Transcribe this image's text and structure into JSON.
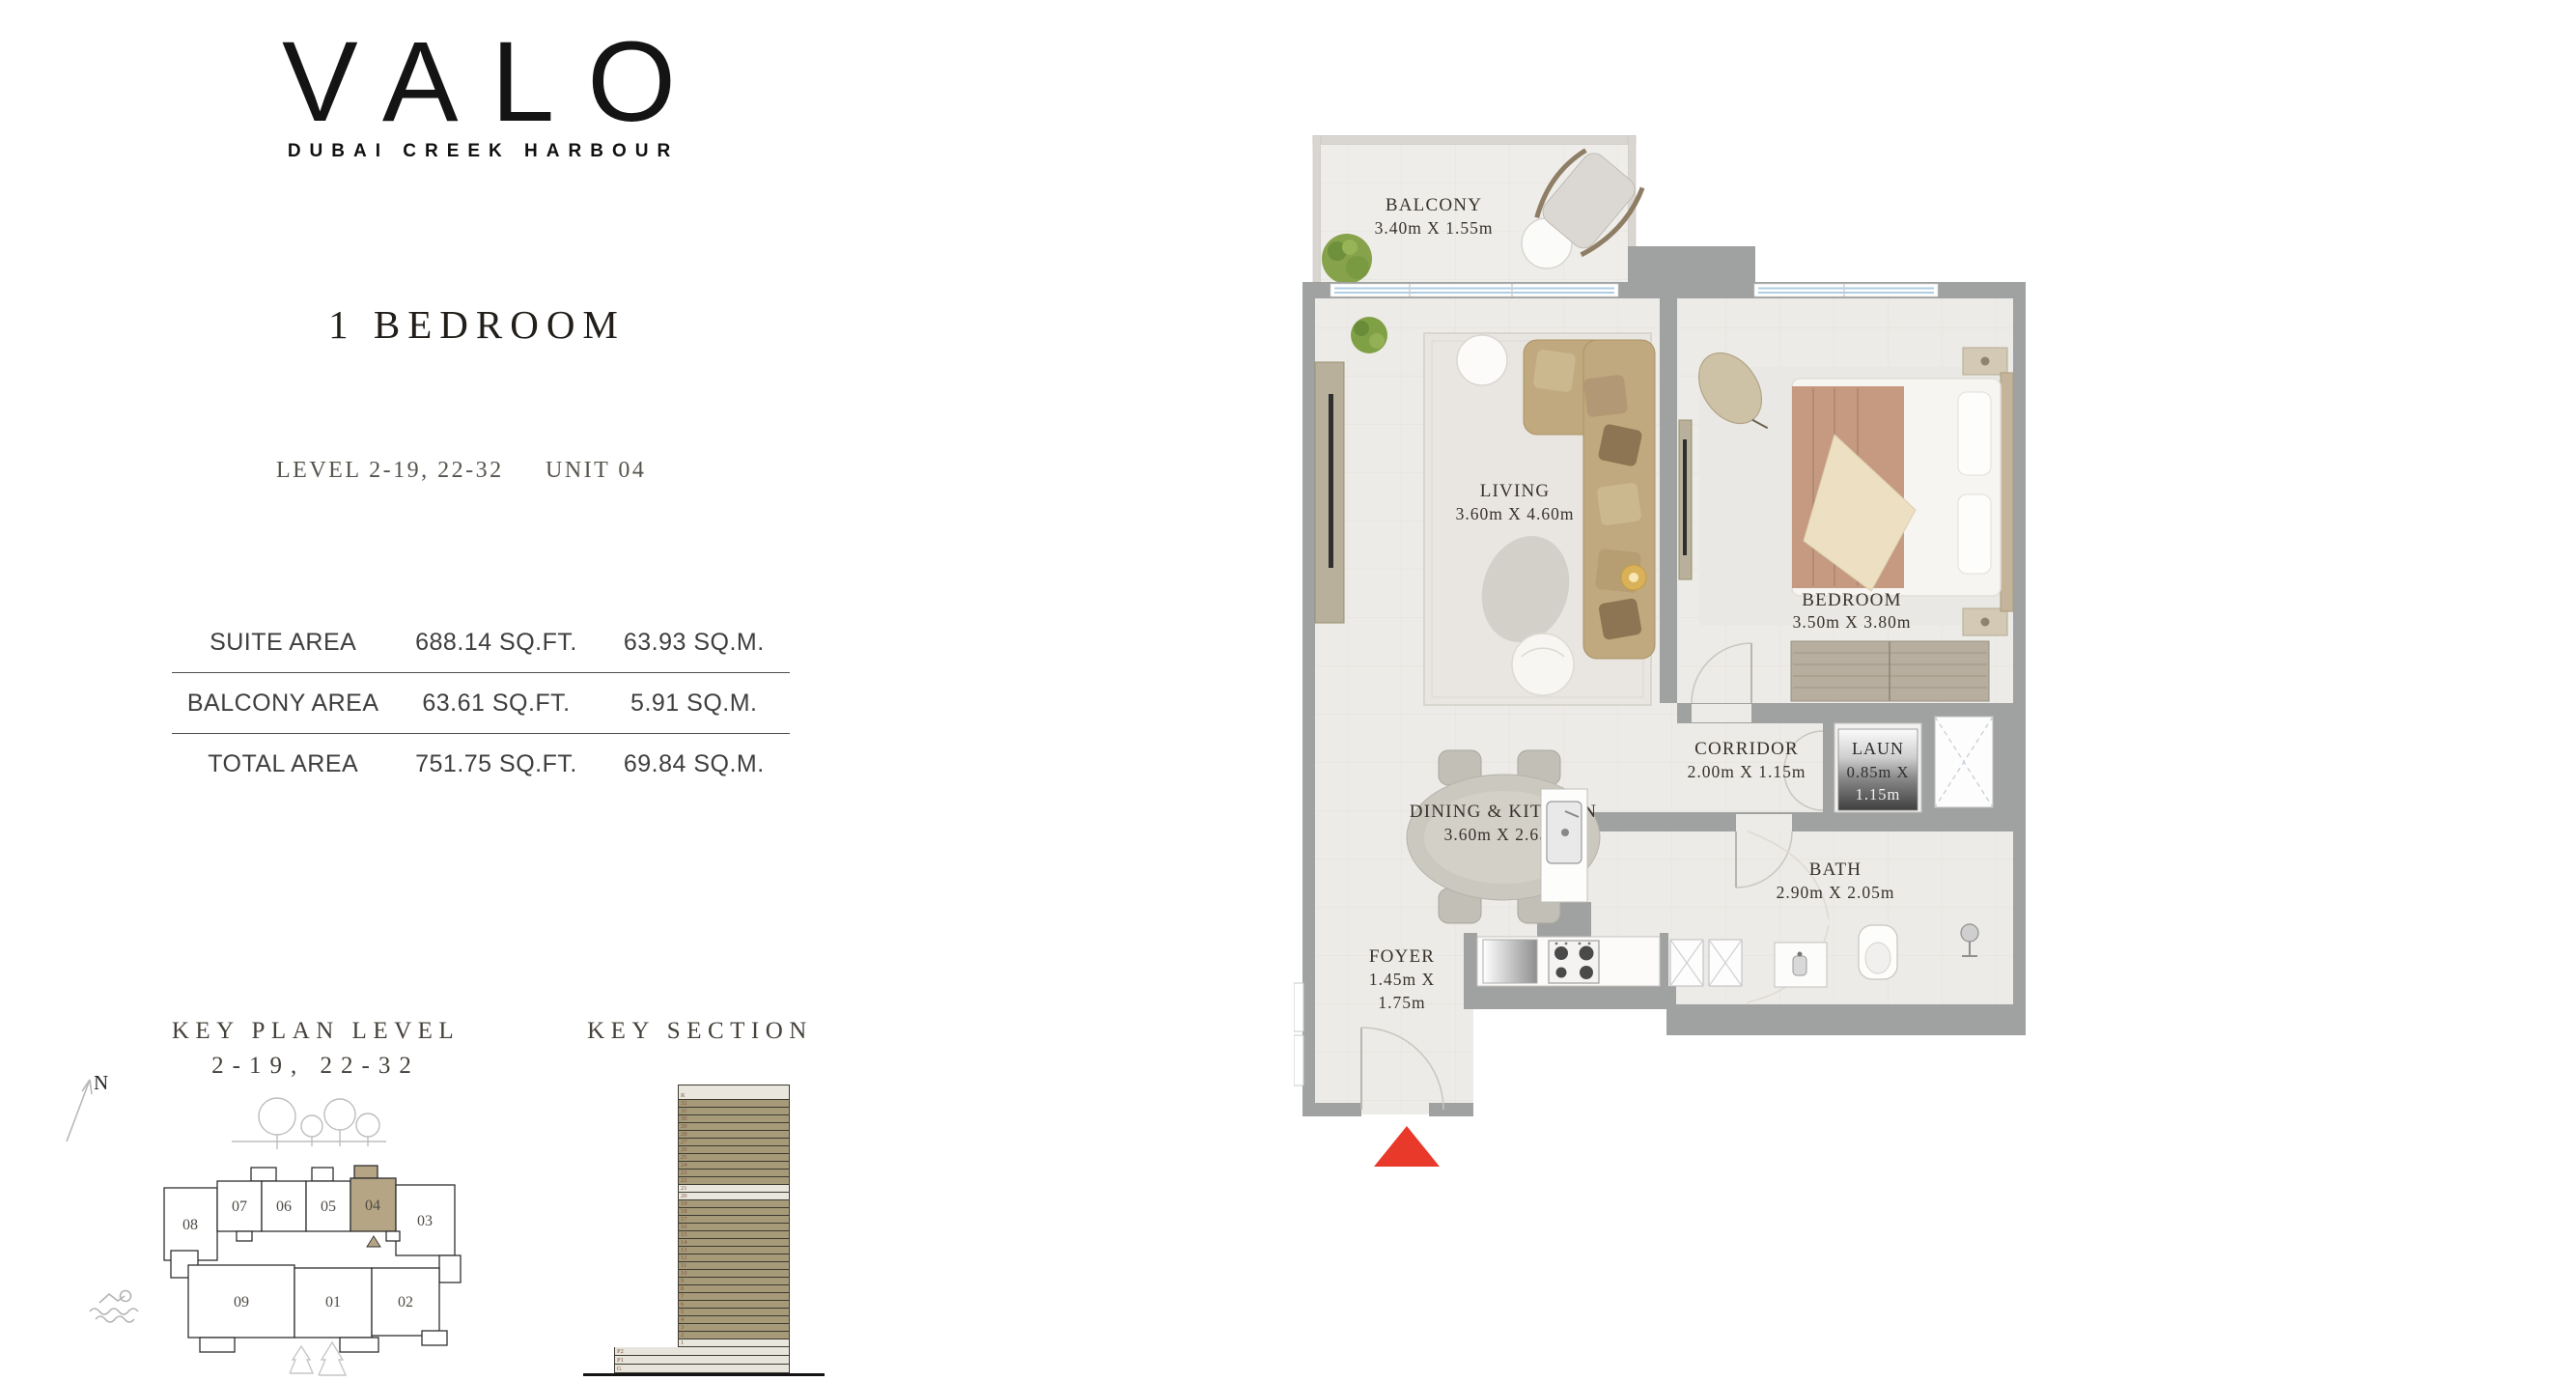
{
  "brand": {
    "name": "VALO",
    "tagline": "DUBAI CREEK HARBOUR"
  },
  "listing": {
    "title": "1 BEDROOM",
    "level": "LEVEL 2-19, 22-32",
    "unit": "UNIT 04"
  },
  "area_table": {
    "rows": [
      {
        "label": "SUITE AREA",
        "sqft": "688.14 SQ.FT.",
        "sqm": "63.93 SQ.M."
      },
      {
        "label": "BALCONY AREA",
        "sqft": "63.61 SQ.FT.",
        "sqm": "5.91 SQ.M."
      },
      {
        "label": "TOTAL AREA",
        "sqft": "751.75 SQ.FT.",
        "sqm": "69.84 SQ.M."
      }
    ]
  },
  "key_plan": {
    "title_line1": "KEY PLAN LEVEL",
    "title_line2": "2-19, 22-32",
    "north_label": "N",
    "units": [
      "08",
      "07",
      "06",
      "05",
      "04",
      "03",
      "09",
      "01",
      "02"
    ],
    "highlighted_unit": "04"
  },
  "key_section": {
    "title": "KEY SECTION",
    "tower_floors": [
      {
        "label": "R",
        "highlighted": false
      },
      {
        "label": "32",
        "highlighted": true
      },
      {
        "label": "31",
        "highlighted": true
      },
      {
        "label": "30",
        "highlighted": true
      },
      {
        "label": "29",
        "highlighted": true
      },
      {
        "label": "28",
        "highlighted": true
      },
      {
        "label": "27",
        "highlighted": true
      },
      {
        "label": "26",
        "highlighted": true
      },
      {
        "label": "25",
        "highlighted": true
      },
      {
        "label": "24",
        "highlighted": true
      },
      {
        "label": "23",
        "highlighted": true
      },
      {
        "label": "22",
        "highlighted": true
      },
      {
        "label": "21",
        "highlighted": false
      },
      {
        "label": "20",
        "highlighted": false
      },
      {
        "label": "19",
        "highlighted": true
      },
      {
        "label": "18",
        "highlighted": true
      },
      {
        "label": "17",
        "highlighted": true
      },
      {
        "label": "16",
        "highlighted": true
      },
      {
        "label": "15",
        "highlighted": true
      },
      {
        "label": "14",
        "highlighted": true
      },
      {
        "label": "13",
        "highlighted": true
      },
      {
        "label": "12",
        "highlighted": true
      },
      {
        "label": "11",
        "highlighted": true
      },
      {
        "label": "10",
        "highlighted": true
      },
      {
        "label": "9",
        "highlighted": true
      },
      {
        "label": "8",
        "highlighted": true
      },
      {
        "label": "7",
        "highlighted": true
      },
      {
        "label": "6",
        "highlighted": true
      },
      {
        "label": "5",
        "highlighted": true
      },
      {
        "label": "4",
        "highlighted": true
      },
      {
        "label": "3",
        "highlighted": true
      },
      {
        "label": "2",
        "highlighted": true
      },
      {
        "label": "1",
        "highlighted": false
      }
    ],
    "podium_floors": [
      "P2",
      "P1",
      "G"
    ]
  },
  "floor_plan": {
    "rooms": {
      "balcony": {
        "name": "BALCONY",
        "dims": "3.40m X 1.55m"
      },
      "living": {
        "name": "LIVING",
        "dims": "3.60m X 4.60m"
      },
      "bedroom": {
        "name": "BEDROOM",
        "dims": "3.50m X 3.80m"
      },
      "dining_kitchen": {
        "name": "DINING & KITCHEN",
        "dims": "3.60m X 2.65m"
      },
      "corridor": {
        "name": "CORRIDOR",
        "dims": "2.00m X 1.15m"
      },
      "laundry": {
        "lines": [
          "LAUN",
          "0.85m X",
          "1.15m"
        ]
      },
      "bath": {
        "name": "BATH",
        "dims": "2.90m X 2.05m"
      },
      "foyer": {
        "lines": [
          "FOYER",
          "1.45m X",
          "1.75m"
        ]
      }
    }
  },
  "colors": {
    "wall": "#a0a2a2",
    "floor": "#edebe7",
    "accent_tan": "#b5a585",
    "window_glass": "#aecde2",
    "entry_red": "#e8392b"
  }
}
